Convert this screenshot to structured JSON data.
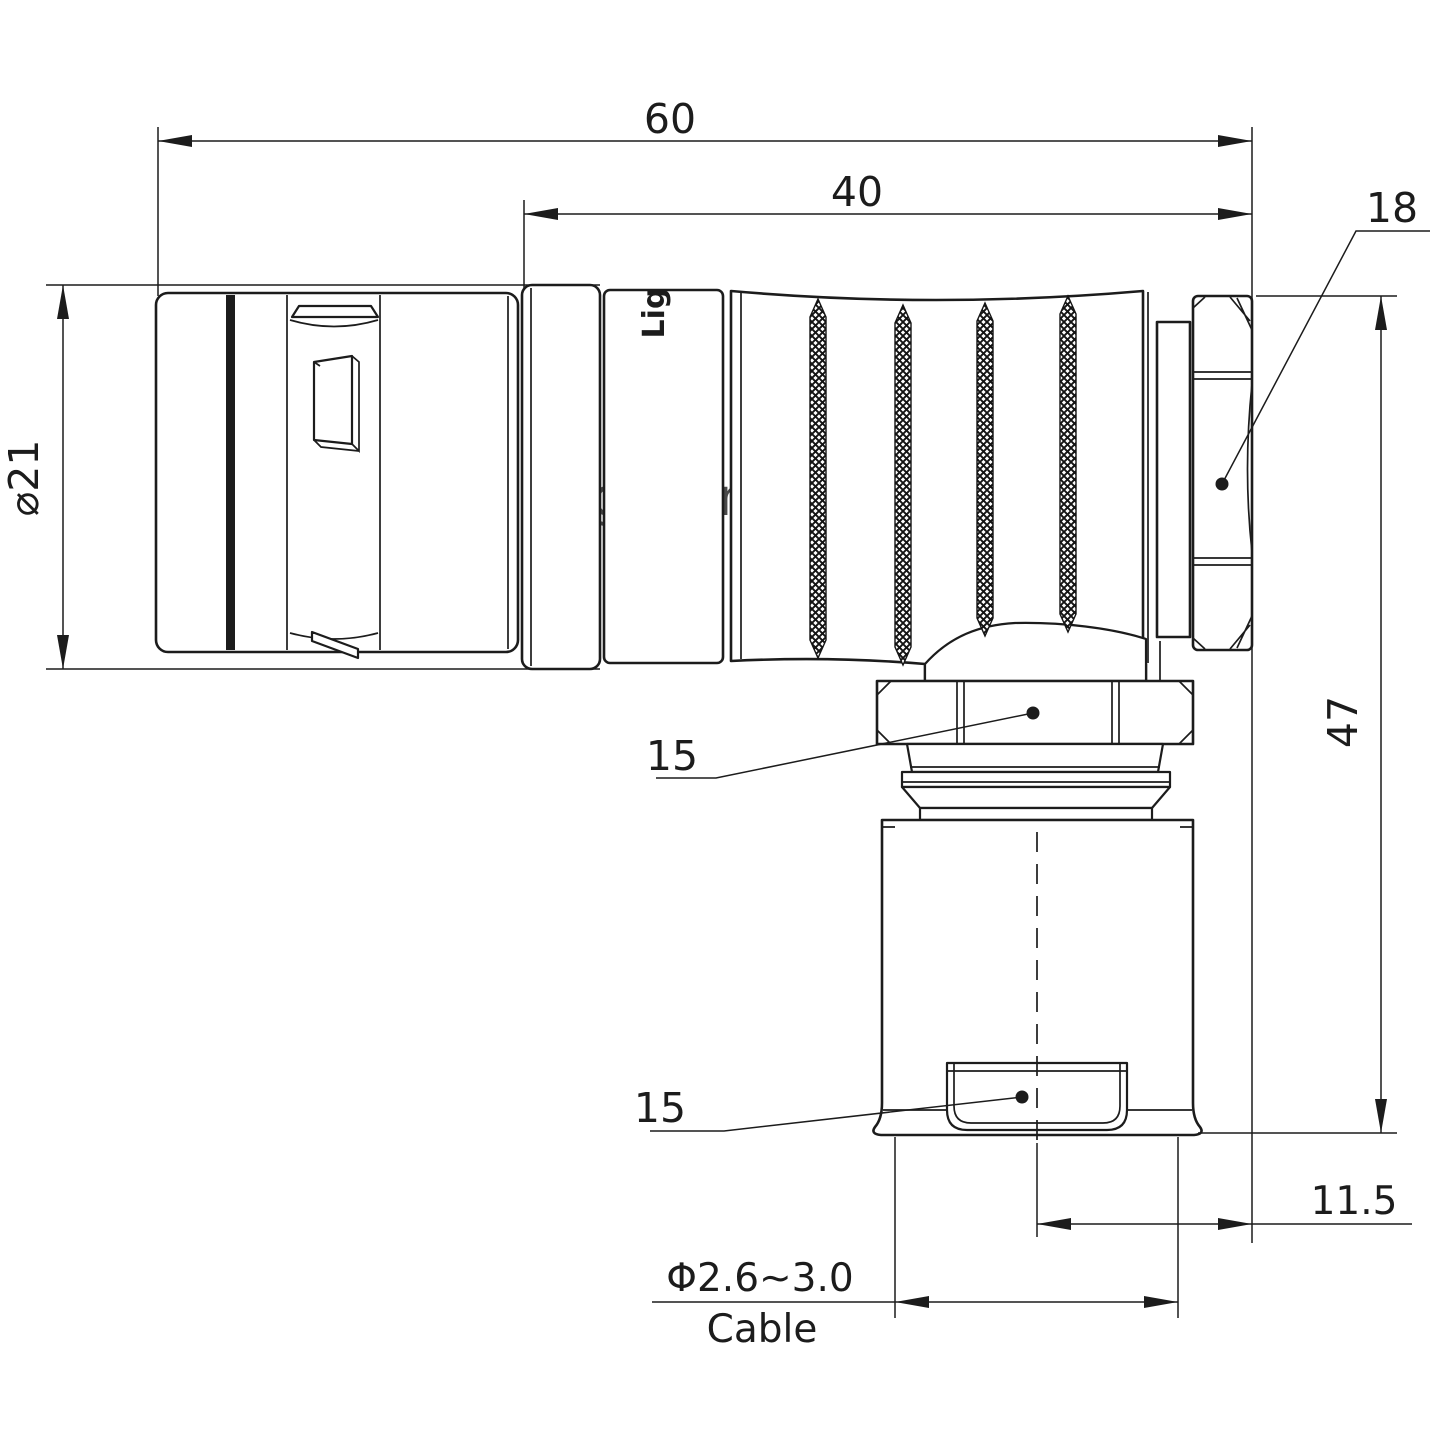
{
  "drawing": {
    "watermark": "Lightany",
    "body_marking": "Lig",
    "colors": {
      "line": "#1c1c1c",
      "background": "#ffffff",
      "watermark_pink": "#f6d0d0"
    },
    "dimensions": {
      "overall_length": "60",
      "rear_length": "40",
      "backnut_width": "18",
      "front_diameter": "⌀21",
      "overall_height": "47",
      "coupling_nut_width": "15",
      "cable_clamp_width": "15",
      "axis_offset": "11.5",
      "cable_diameter": "Φ2.6~3.0",
      "cable_label": "Cable"
    }
  }
}
